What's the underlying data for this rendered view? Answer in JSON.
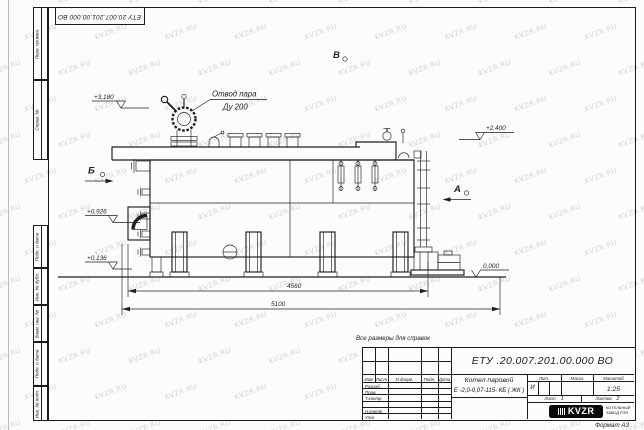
{
  "watermark": {
    "text": "KVZR.RU"
  },
  "frame": {
    "top_stamp": "ЕТУ 20.007.201.00.000  ВО",
    "side_labels": [
      {
        "label": "Перв. примен."
      },
      {
        "label": "Справ. №"
      },
      {
        "label": "Подп. и дата"
      },
      {
        "label": "Инв. № дубл."
      },
      {
        "label": "Взам. инв. №"
      },
      {
        "label": "Подп. и дата"
      },
      {
        "label": "Инв. № подл."
      }
    ],
    "format_note": "Формат А3"
  },
  "drawing": {
    "callout": {
      "line1": "Отвод пара",
      "line2": "Ду 200"
    },
    "elevations": {
      "steam_valve_top": "+3,180",
      "boiler_top": "+2,400",
      "burner_axis": "+0,926",
      "base_low": "+0,136",
      "ground": "0,000"
    },
    "views": {
      "front": "Б",
      "rear": "А",
      "top": "В"
    },
    "dimensions": {
      "boiler_length": "4560",
      "overall_length": "5100"
    }
  },
  "title_block": {
    "note": "Все размеры для справок",
    "doc_number": "ЕТУ .20.007.201.00.000  ВО",
    "product_name_line1": "Котел паровой",
    "product_name_line2": "Е -2,0-0,07-115- КБ ( ЖК )",
    "columns": [
      "Изм.",
      "Лист",
      "N докум.",
      "Подп.",
      "Дата"
    ],
    "rows": [
      "Разраб.",
      "Пров.",
      "Т.контр",
      "Н.контр",
      "Утв."
    ],
    "lit_header": "Лит.",
    "mass_header": "Масса",
    "scale_header": "Масштаб",
    "lit_value": "И",
    "scale_value": "1:25",
    "sheet_label": "Лист",
    "sheet_value": "1",
    "sheets_label": "Листов",
    "sheets_value": "2",
    "company": {
      "logo_text": "KVZR",
      "name_line1": "КОТЕЛЬНЫЙ",
      "name_line2": "ЗАВОД РЭП"
    }
  }
}
